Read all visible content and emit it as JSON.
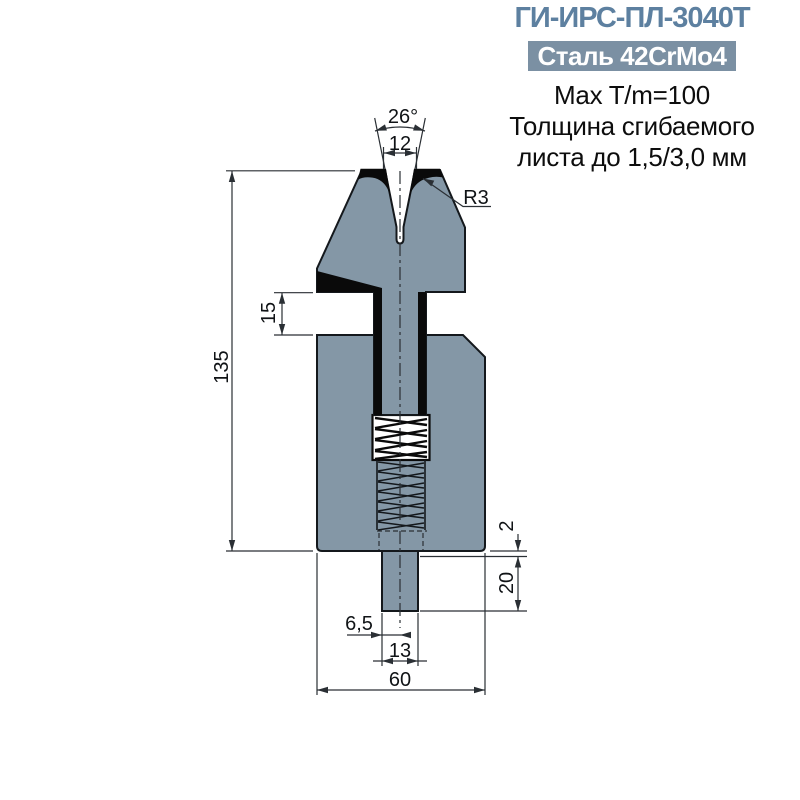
{
  "header": {
    "title": "ГИ-ИРС-ПЛ-3040Т",
    "material_badge": "Сталь 42CrMo4",
    "spec_lines": {
      "max_tonnage": "Max T/m=100",
      "thickness_line1": "Толщина сгибаемого",
      "thickness_line2": "листа до 1,5/3,0 мм"
    }
  },
  "drawing": {
    "dims": {
      "vee_angle": "26°",
      "vee_width": "12",
      "edge_radius": "R3",
      "total_height": "135",
      "slot_depth": "15",
      "step": "2",
      "tang_height": "20",
      "tang_half_width": "6,5",
      "tang_width": "13",
      "body_width": "60"
    },
    "colors": {
      "steel_fill": "#8497A6",
      "accent_black": "#0A0A0A",
      "pocket_white": "#FFFFFF",
      "title_color": "#5D80A0",
      "badge_bg": "#7B90A3"
    }
  }
}
